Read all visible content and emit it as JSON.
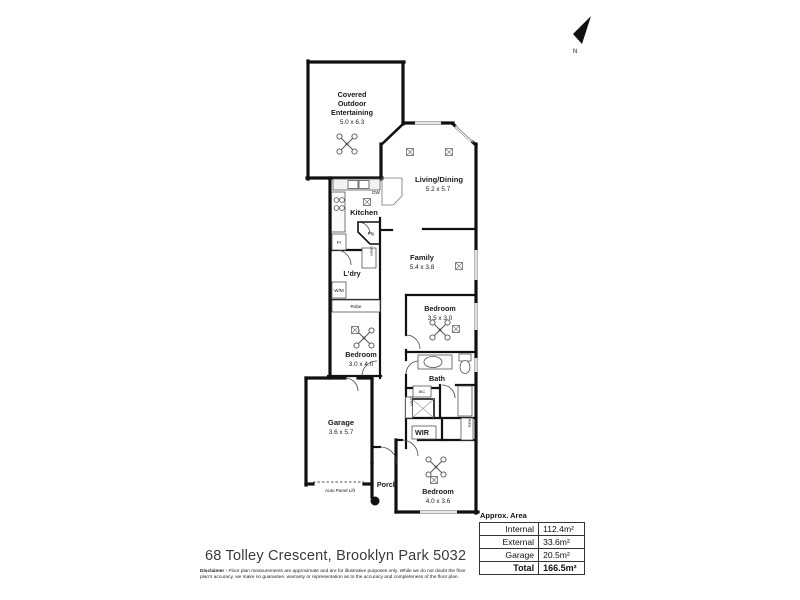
{
  "north": {
    "label": "N"
  },
  "rooms": {
    "entertaining": {
      "line1": "Covered",
      "line2": "Outdoor",
      "line3": "Entertaining",
      "dims": "5.0 x 6.3"
    },
    "living": {
      "name": "Living/Dining",
      "dims": "5.2 x 5.7"
    },
    "kitchen": {
      "name": "Kitchen"
    },
    "family": {
      "name": "Family",
      "dims": "5.4 x 3.8"
    },
    "laundry": {
      "name": "L'dry"
    },
    "bedroom_mid": {
      "name": "Bedroom",
      "dims": "3.5 x 3.0"
    },
    "bedroom_left": {
      "name": "Bedroom",
      "dims": "3.0 x 4.0"
    },
    "bath": {
      "name": "Bath"
    },
    "garage": {
      "name": "Garage",
      "dims": "3.6 x 5.7",
      "door": "Auto Panel Lift"
    },
    "wir": {
      "name": "WIR"
    },
    "porch": {
      "name": "Porch"
    },
    "bedroom_rear": {
      "name": "Bedroom",
      "dims": "4.0 x 3.6"
    }
  },
  "fixtures": {
    "dishwasher": "DW",
    "pantry": "Pty",
    "fridge": "Fr",
    "washing_machine": "W/M",
    "linen_hall": "Linen",
    "robe_bed_left": "Robe",
    "bic": "BIC",
    "linen_bath": "Linen",
    "robe_bed_rear": "Robe"
  },
  "area_table": {
    "title": "Approx. Area",
    "rows": [
      {
        "label": "Internal",
        "value": "112.4m²"
      },
      {
        "label": "External",
        "value": "33.6m²"
      },
      {
        "label": "Garage",
        "value": "20.5m²"
      },
      {
        "label": "Total",
        "value": "166.5m²"
      }
    ]
  },
  "footer": {
    "address": "68 Tolley Crescent, Brooklyn Park 5032",
    "disclaimer_label": "Disclaimer -",
    "disclaimer_text": "Floor plan measurements are approximate and are for illustrative purposes only. While we do not doubt the floor plan's accuracy, we make no guarantee, warranty or representation as to the accuracy and completeness of the floor plan."
  }
}
